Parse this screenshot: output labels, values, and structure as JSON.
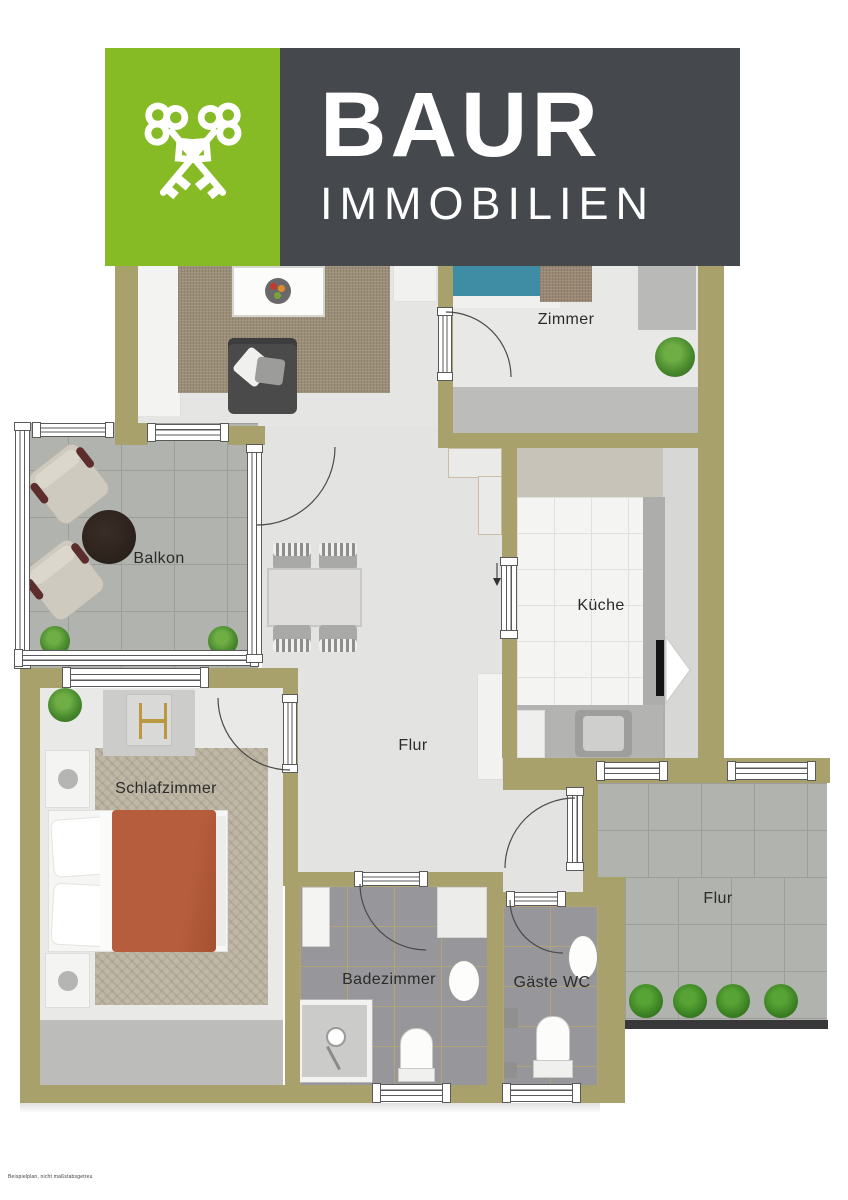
{
  "header": {
    "brand": "BAUR",
    "subtitle": "IMMOBILIEN",
    "icon": "crossed-keys"
  },
  "rooms": {
    "zimmer": {
      "label": "Zimmer"
    },
    "balkon": {
      "label": "Balkon"
    },
    "kueche": {
      "label": "Küche"
    },
    "flur": {
      "label": "Flur"
    },
    "schlafzimmer": {
      "label": "Schlafzimmer"
    },
    "badezimmer": {
      "label": "Badezimmer"
    },
    "gaeste_wc": {
      "label": "Gäste WC"
    },
    "aussen_flur": {
      "label": "Flur"
    }
  },
  "footer": {
    "disclaimer": "Beispielplan, nicht maßstabsgetreu"
  },
  "colors": {
    "logo_green": "#86bb25",
    "logo_dark": "#45494d",
    "wall": "#a9a16c",
    "accent_bed": "#b65d3d",
    "accent_zimmer_bed": "#3e8da5"
  }
}
